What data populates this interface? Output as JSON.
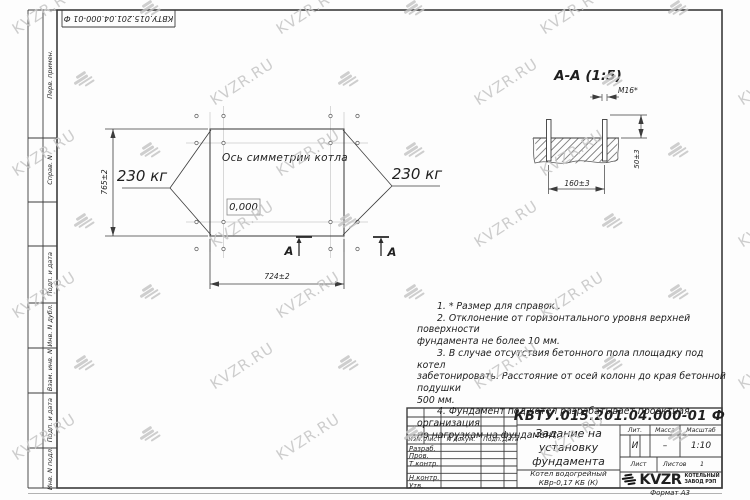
{
  "watermark": {
    "text": "KVZR.RU"
  },
  "frame": {
    "doc_number_top": "КВТУ.015.201.04.000-01 Ф",
    "margin_labels": [
      "Перв. примен.",
      "Справ. N",
      "Подп. и дата",
      "Инв. N дубл.",
      "Взам. инв. N",
      "Подп. и дата",
      "Инв. N подл."
    ],
    "format_label": "Формат А3"
  },
  "plan": {
    "symmetry_label": "Ось симметрии котла",
    "level_mark": "0,000",
    "load_left": "230 кг",
    "load_right": "230 кг",
    "dim_height": "765±2",
    "dim_width": "724±2",
    "section_letter_left": "А",
    "section_letter_right": "А"
  },
  "section_view": {
    "title": "А-А (1:5)",
    "bolt_thread": "М16*",
    "dim_protrusion": "50±3",
    "dim_spacing": "160±3"
  },
  "notes": {
    "lines": [
      {
        "text": "1. * Размер для справок ."
      },
      {
        "text": "2. Отклонение от горизонтального уровня верхней поверхности"
      },
      {
        "text": "фундамента не более 10 мм."
      },
      {
        "text": "3. В случае отсутствия бетонного пола площадку под котел"
      },
      {
        "text": "забетонировать. Расстояние от осей колонн до края бетонной подушки"
      },
      {
        "text": "500 мм."
      },
      {
        "text": "4. Фундамент под котел разрабатывает проектная организация"
      },
      {
        "text": "по нагрузкам на фундамент."
      }
    ]
  },
  "title_block": {
    "doc_number": "КВТУ.015.201.04.000-01 Ф",
    "title_line1": "Задание на",
    "title_line2": "установку",
    "title_line3": "фундамента",
    "product_line1": "Котел водогрейный",
    "product_line2": "КВр-0,17 КБ (К)",
    "headers": {
      "izm": "Изм.",
      "list": "Лист",
      "doc": "N докум.",
      "podp": "Подп.",
      "data": "Дата",
      "lit": "Лит.",
      "massa": "Масса",
      "masshtab": "Масштаб",
      "listov": "Листов"
    },
    "rows": [
      "Разраб.",
      "Пров.",
      "Т.контр.",
      "",
      "Н.контр.",
      "Утв."
    ],
    "lit_value": "И",
    "massa_value": "–",
    "scale_value": "1:10",
    "listov_value": "1",
    "logo_text": "KVZR",
    "logo_sub1": "КОТЕЛЬНЫЙ",
    "logo_sub2": "ЗАВОД РЭП"
  }
}
